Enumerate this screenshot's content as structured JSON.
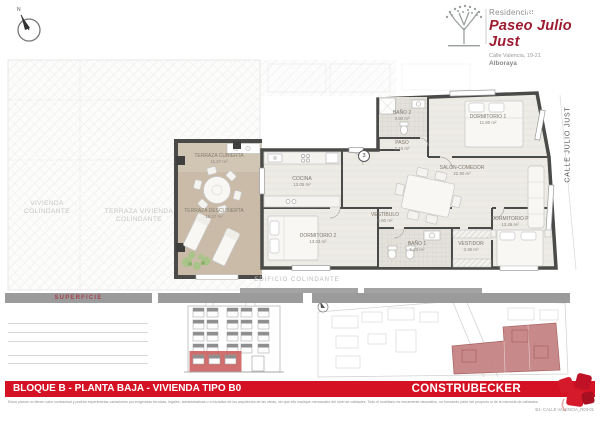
{
  "page": {
    "compass_n": "N"
  },
  "brand": {
    "residencial": "Residencial",
    "title": "Paseo Julio Just",
    "address": "Calle Valencia, 19-21",
    "city": "Alboraya"
  },
  "plan": {
    "marker": "3",
    "rooms": [
      {
        "name": "TERRAZA CUBIERTA",
        "area": "11.27 m²"
      },
      {
        "name": "TERRAZA DESCUBIERTA",
        "area": "18.27 m²"
      },
      {
        "name": "COCINA",
        "area": "13.05 m²"
      },
      {
        "name": "SALÓN-COMEDOR",
        "area": "22.90 m²"
      },
      {
        "name": "BAÑO 2",
        "area": "3.80 m²"
      },
      {
        "name": "PASO",
        "area": "2.16 m²"
      },
      {
        "name": "DORMITORIO 1",
        "area": "11.80 m²"
      },
      {
        "name": "VESTÍBULO",
        "area": "5.60 m²"
      },
      {
        "name": "DORMITORIO 2",
        "area": "13.03 m²"
      },
      {
        "name": "BAÑO 1",
        "area": "5.23 m²"
      },
      {
        "name": "VESTIDOR",
        "area": "3.36 m²"
      },
      {
        "name": "DORMITORIO P",
        "area": "13.26 m²"
      }
    ],
    "context": {
      "vivienda_colindante": "VIVIENDA COLINDANTE",
      "terraza_vivienda_colindante": "TERRAZA VIVIENDA COLINDANTE",
      "edificio_colindante": "EDIFICIO COLINDANTE",
      "calle": "CALLE JULIO JUST"
    }
  },
  "superficie": {
    "header": "SUPERFICIE"
  },
  "footer": {
    "bar_regular": "BLOQUE B - PLANTA BAJA - ",
    "bar_bold": "VIVIENDA TIPO B0",
    "brand": "CONSTRUBECKER",
    "disclaimer": "Estos planos no tienen valor contractual y podrán experimentar variaciones por exigencias técnicas, legales, administrativas o a iniciativa de los arquitectos de las obras, sin que ello implique menoscabo del nivel de calidades. Todo el mobiliario es meramente decorativo, no formando parte del proyecto ni de la memoria de calidades.",
    "reference": "B1- CALLE VALENCIA_R03-01"
  },
  "colors": {
    "accent_red": "#d41224",
    "title_red": "#9c1b31",
    "bar_gray": "#9b9b9b"
  }
}
